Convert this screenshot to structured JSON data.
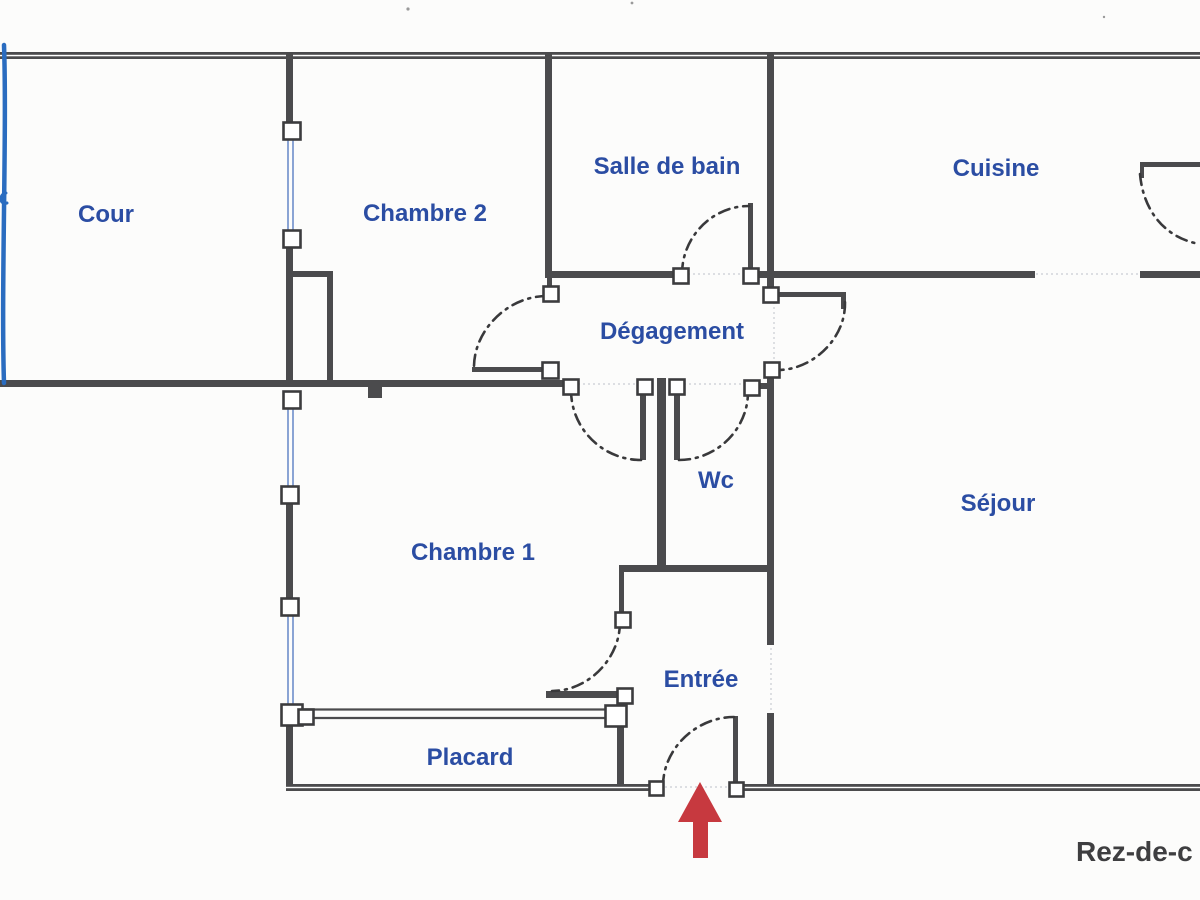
{
  "plan": {
    "title_floor": "Rez-de-c",
    "rooms": {
      "cour": "Cour",
      "chambre2": "Chambre 2",
      "salle_de_bain": "Salle de bain",
      "cuisine": "Cuisine",
      "degagement": "Dégagement",
      "wc": "Wc",
      "sejour": "Séjour",
      "chambre1": "Chambre 1",
      "entree": "Entrée",
      "placard": "Placard"
    },
    "colors": {
      "label_blue": "#2b4da3",
      "wall_gray": "#4b4b4d",
      "floor_label_gray": "#3e3e40",
      "arrow_red": "#c7393f",
      "window_blue": "#5b7fc4",
      "artifact_blue": "#2a6cc0"
    }
  }
}
